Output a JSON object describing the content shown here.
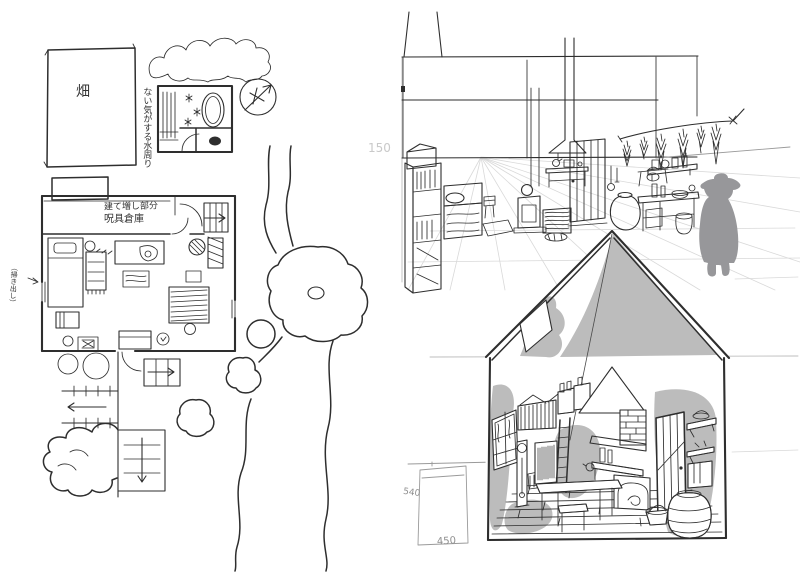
{
  "canvas": {
    "background": "#ffffff",
    "ink": "#2e2e2e",
    "shade_gray": "#bcbcbc",
    "figure_gray": "#97979a",
    "pencil_gray": "#c9c9c9"
  },
  "floor_plan": {
    "field_label": "畑",
    "bath_note": "ない気がする水周り",
    "extension_note_line1": "建て増し部分",
    "extension_note_line2": "呪具倉庫",
    "wall_note": "（掃き出し）",
    "compass_icon": "north-compass",
    "arrows": {
      "entry": "→",
      "porch": "→",
      "path_left": "←",
      "path_down": "↓",
      "wall_note": "→"
    }
  },
  "annotations": {
    "faint_dim": "150",
    "door_height": "540",
    "door_width": "450"
  }
}
